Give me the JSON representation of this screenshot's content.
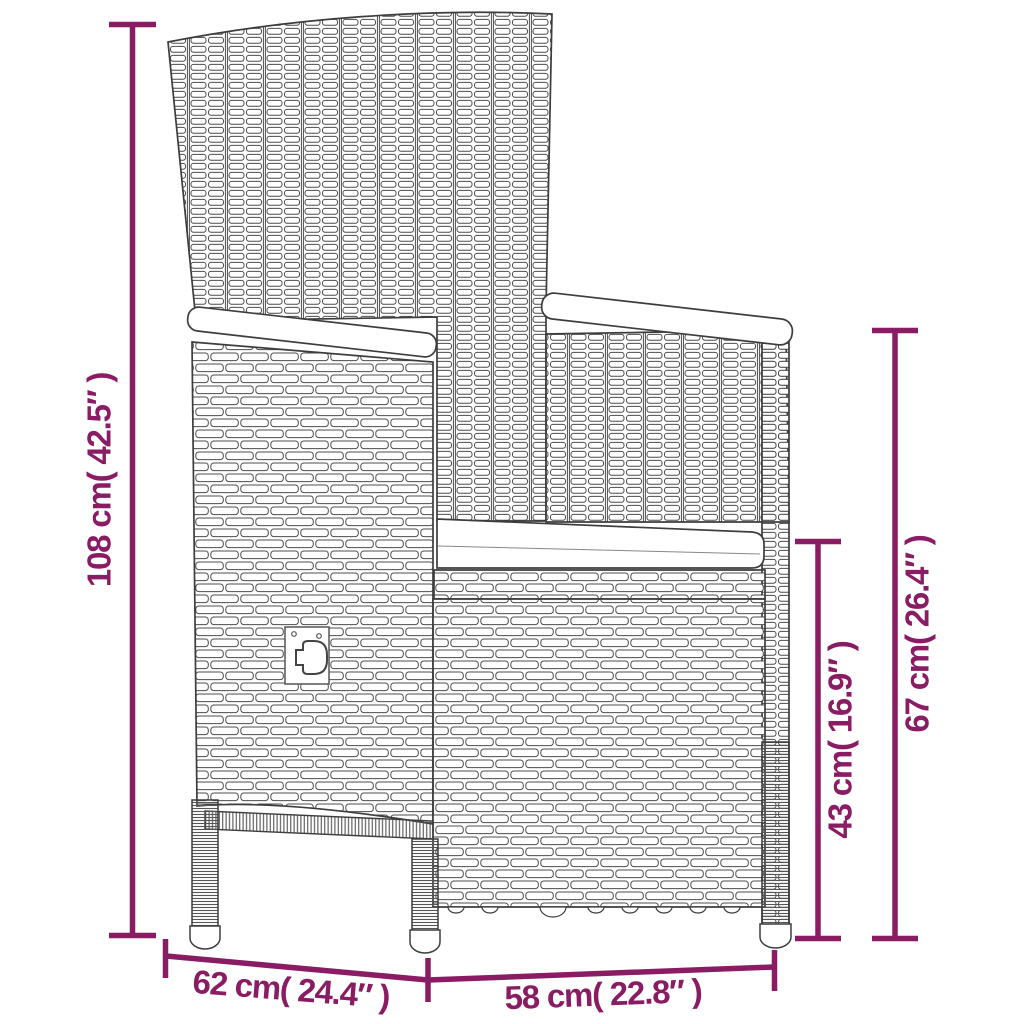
{
  "diagram": {
    "type": "product-dimension-diagram",
    "subject": "wicker outdoor armchair line drawing with seat cushion",
    "colors": {
      "dimension_annotation": "#8a1c64",
      "drawing_outline": "#3d3d3d",
      "background": "#ffffff"
    },
    "labels": {
      "total_height": "108 cm( 42.5″ )",
      "back_height": "67 cm( 26.4″ )",
      "seat_height": "43 cm( 16.9″ )",
      "depth": "62 cm( 24.4″ )",
      "width": "58 cm( 22.8″ )"
    },
    "values": {
      "total_height_cm": 108,
      "total_height_in": 42.5,
      "back_height_cm": 67,
      "back_height_in": 26.4,
      "seat_height_cm": 43,
      "seat_height_in": 16.9,
      "depth_cm": 62,
      "depth_in": 24.4,
      "width_cm": 58,
      "width_in": 22.8
    }
  }
}
